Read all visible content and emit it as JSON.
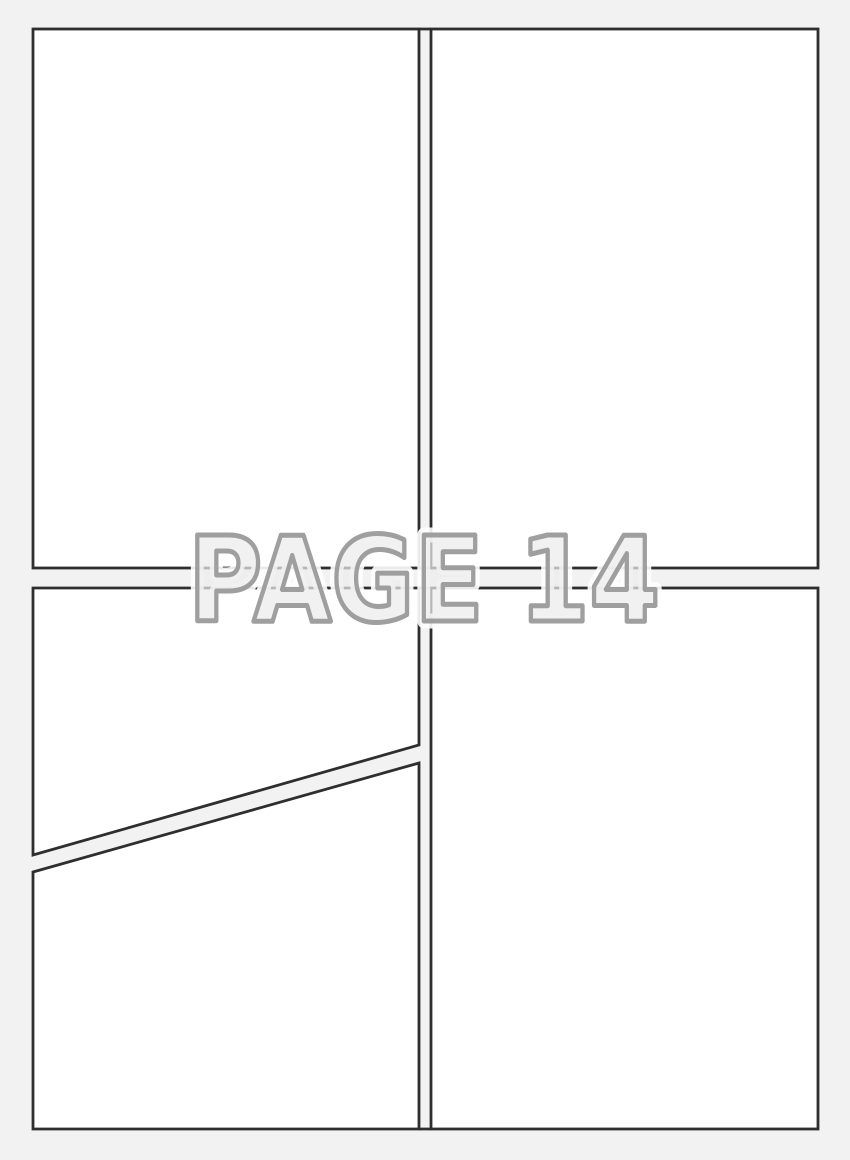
{
  "page_label": "PAGE 14",
  "template": {
    "type": "comic-page-template",
    "panel_count": 4,
    "panels": [
      {
        "id": "top-left",
        "shape": "rectangle"
      },
      {
        "id": "top-right",
        "shape": "rectangle"
      },
      {
        "id": "bottom-left",
        "shape": "diagonal-split",
        "sub_panels": 2
      },
      {
        "id": "bottom-right",
        "shape": "rectangle"
      }
    ]
  },
  "colors": {
    "background": "#f2f2f3",
    "panel_fill": "#ffffff",
    "panel_border": "#2e2e2e",
    "label_fill": "#ebebeb",
    "label_outline": "#9a9a9a",
    "label_halo": "#ffffff"
  }
}
